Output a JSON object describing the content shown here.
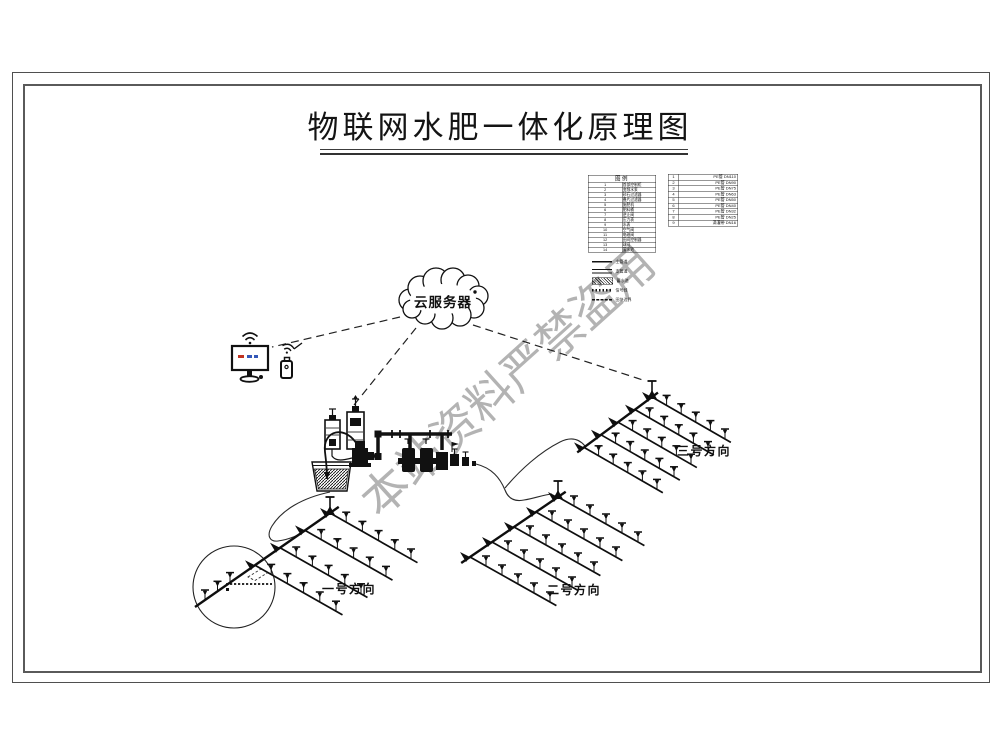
{
  "title": {
    "text": "物联网水肥一体化原理图"
  },
  "watermark": {
    "text": "本站资料严禁盗用",
    "color": "#a3a3a3"
  },
  "cloud": {
    "label": "云服务器"
  },
  "legend": {
    "header": "图例",
    "items": [
      {
        "no": "1",
        "label": "首部控制柜"
      },
      {
        "no": "2",
        "label": "变频水泵"
      },
      {
        "no": "3",
        "label": "砂石过滤器"
      },
      {
        "no": "4",
        "label": "叠片过滤器"
      },
      {
        "no": "5",
        "label": "施肥机"
      },
      {
        "no": "6",
        "label": "肥料桶"
      },
      {
        "no": "7",
        "label": "逆止阀"
      },
      {
        "no": "8",
        "label": "压力表"
      },
      {
        "no": "9",
        "label": "水表"
      },
      {
        "no": "10",
        "label": "空气阀"
      },
      {
        "no": "11",
        "label": "电磁阀"
      },
      {
        "no": "12",
        "label": "田间控制器"
      },
      {
        "no": "13",
        "label": "球阀"
      },
      {
        "no": "14",
        "label": "蓄水池"
      }
    ],
    "line_items": [
      {
        "sample": "solid",
        "label": "主管道"
      },
      {
        "sample": "double",
        "label": "支管道"
      },
      {
        "sample": "hatch",
        "label": "蓄水池"
      },
      {
        "sample": "zigzag",
        "label": "信号线"
      },
      {
        "sample": "dashed",
        "label": "田块边界"
      }
    ],
    "pipe_items": [
      {
        "no": "1",
        "label": "PE管 DN110"
      },
      {
        "no": "2",
        "label": "PE管 DN90"
      },
      {
        "no": "3",
        "label": "PE管 DN75"
      },
      {
        "no": "4",
        "label": "PE管 DN63"
      },
      {
        "no": "5",
        "label": "PE管 DN50"
      },
      {
        "no": "6",
        "label": "PE管 DN40"
      },
      {
        "no": "7",
        "label": "PE管 DN32"
      },
      {
        "no": "8",
        "label": "PE管 DN25"
      },
      {
        "no": "9",
        "label": "滴灌带 DN16"
      }
    ]
  },
  "fields": [
    {
      "label": "一号方向",
      "grid": {
        "x": 330,
        "y": 513,
        "main": [
          -25,
          17.4
        ],
        "rows": 6,
        "latRows": [
          0,
          1,
          2,
          3
        ],
        "lat": [
          16.2,
          9.2
        ],
        "cols": 6,
        "mainSpr": [
          4.5
        ]
      }
    },
    {
      "label": "二号方向",
      "grid": {
        "x": 558,
        "y": 497,
        "main": [
          -22,
          15
        ],
        "rows": 5,
        "latRows": [
          0,
          1,
          2,
          3,
          4
        ],
        "lat": [
          16,
          9
        ],
        "cols": 6,
        "mainSpr": []
      }
    },
    {
      "label": "三号方向",
      "grid": {
        "x": 652,
        "y": 397,
        "main": [
          -17,
          12.6
        ],
        "rows": 5,
        "latRows": [
          0,
          1,
          2,
          3,
          4
        ],
        "lat": [
          14.6,
          8.4
        ],
        "cols": 6,
        "mainSpr": []
      }
    }
  ]
}
